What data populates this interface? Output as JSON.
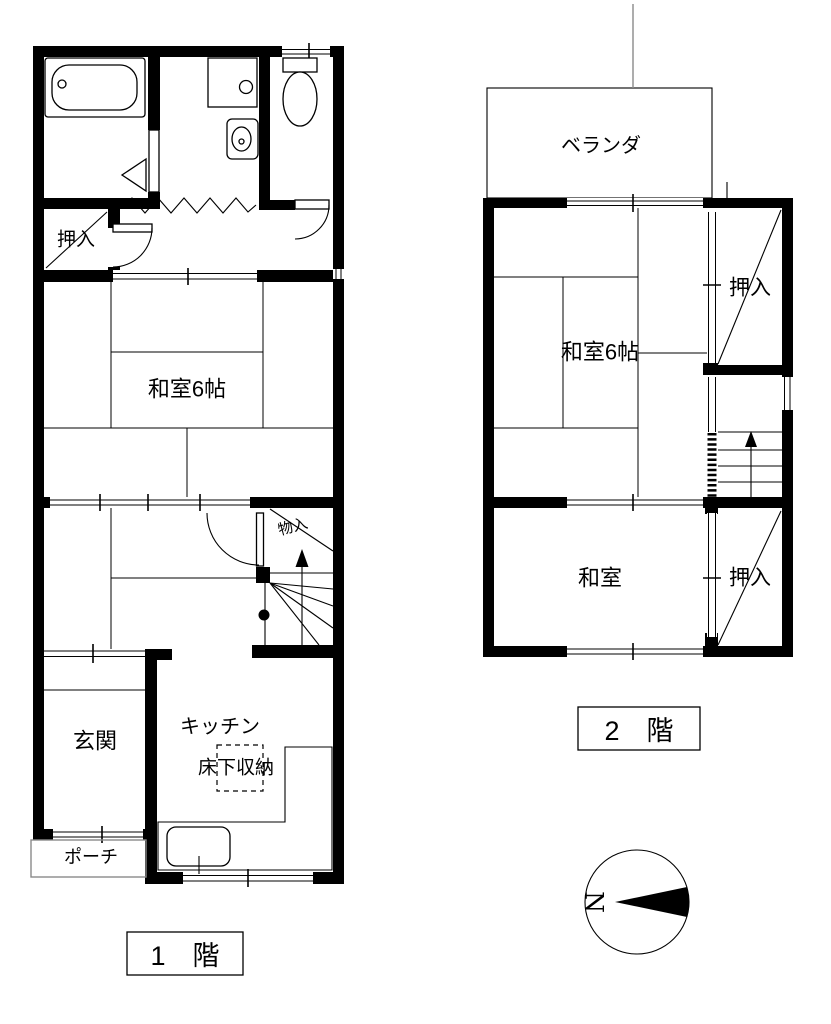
{
  "floor1": {
    "label": "1　階",
    "rooms": {
      "oshiire": "押入",
      "washitsu6": "和室6帖",
      "monoire": "物入",
      "genkan": "玄関",
      "kitchen": "キッチン",
      "yukashita": "床下収納",
      "porch": "ポーチ"
    }
  },
  "floor2": {
    "label": "2　階",
    "rooms": {
      "veranda": "ベランダ",
      "washitsu6": "和室6帖",
      "oshiire_upper": "押入",
      "washitsu": "和室",
      "oshiire_lower": "押入"
    }
  },
  "compass": {
    "north": "N"
  },
  "colors": {
    "wall": "#000000",
    "bg": "#ffffff"
  }
}
